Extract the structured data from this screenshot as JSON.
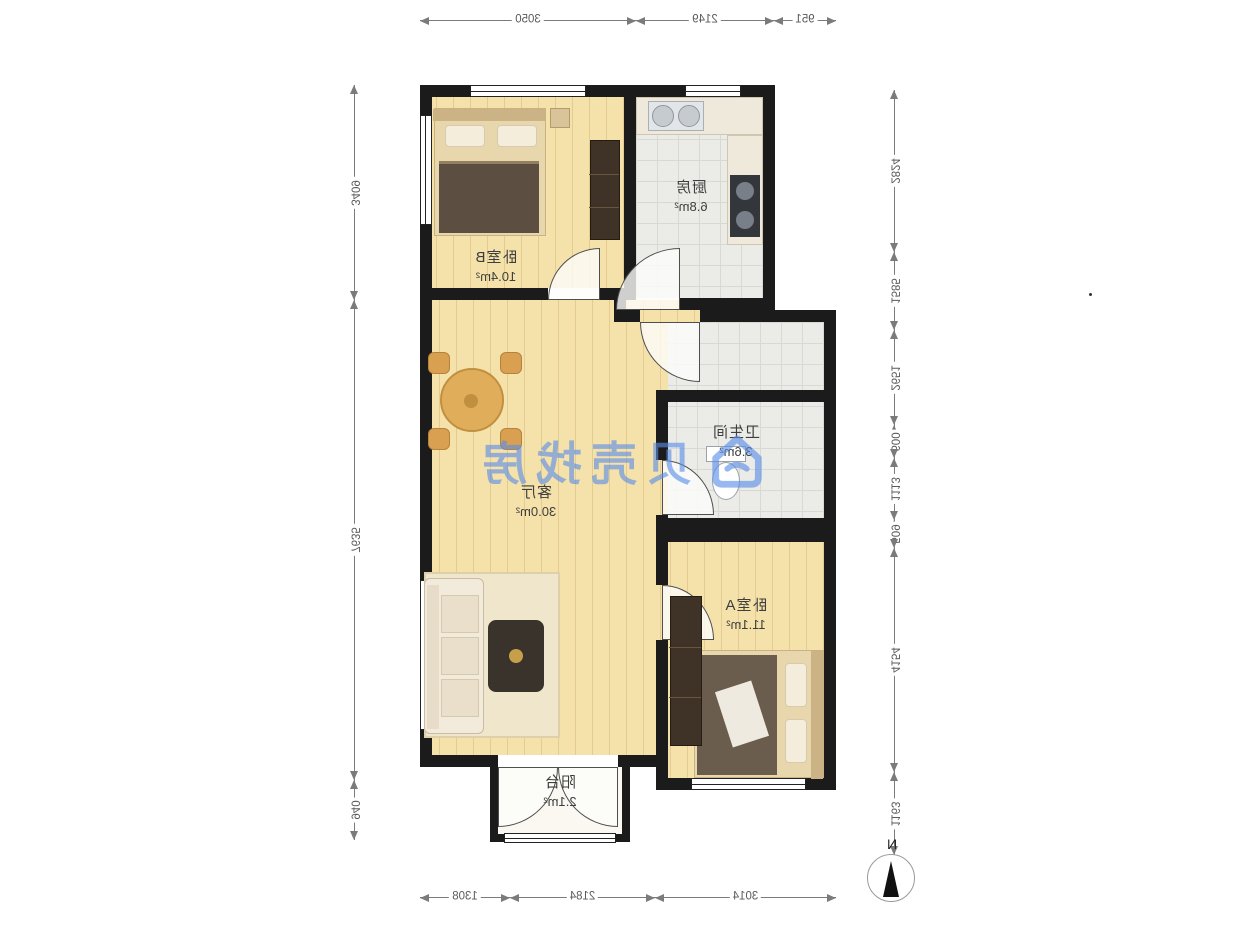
{
  "title": "户型图",
  "watermark": {
    "brand": "贝壳找房",
    "color": "#588CE9"
  },
  "compass": {
    "north_label": "N"
  },
  "rooms": [
    {
      "name": "卧室B",
      "area": "10.4m²"
    },
    {
      "name": "厨房",
      "area": "6.8m²"
    },
    {
      "name": "客厅",
      "area": "30.0m²"
    },
    {
      "name": "卫生间",
      "area": "3.6m²"
    },
    {
      "name": "卧室A",
      "area": "11.1m²"
    },
    {
      "name": "阳台",
      "area": "2.1m²"
    }
  ],
  "dimensions_mm": {
    "top": [
      "951",
      "2149",
      "3050"
    ],
    "bottom": [
      "3014",
      "2184",
      "1308"
    ],
    "right_side": [
      "3409",
      "7635",
      "940"
    ],
    "left_side": [
      "2824",
      "1585",
      "2651",
      "600",
      "1113",
      "509",
      "4154",
      "1163"
    ]
  },
  "colors": {
    "wall": "#1b1b1b",
    "wood_floor": "#f5e2ab",
    "tile_floor": "#ebebe8",
    "watermark_blue": "#588CE9",
    "dimension_text": "#5a5a5a"
  }
}
